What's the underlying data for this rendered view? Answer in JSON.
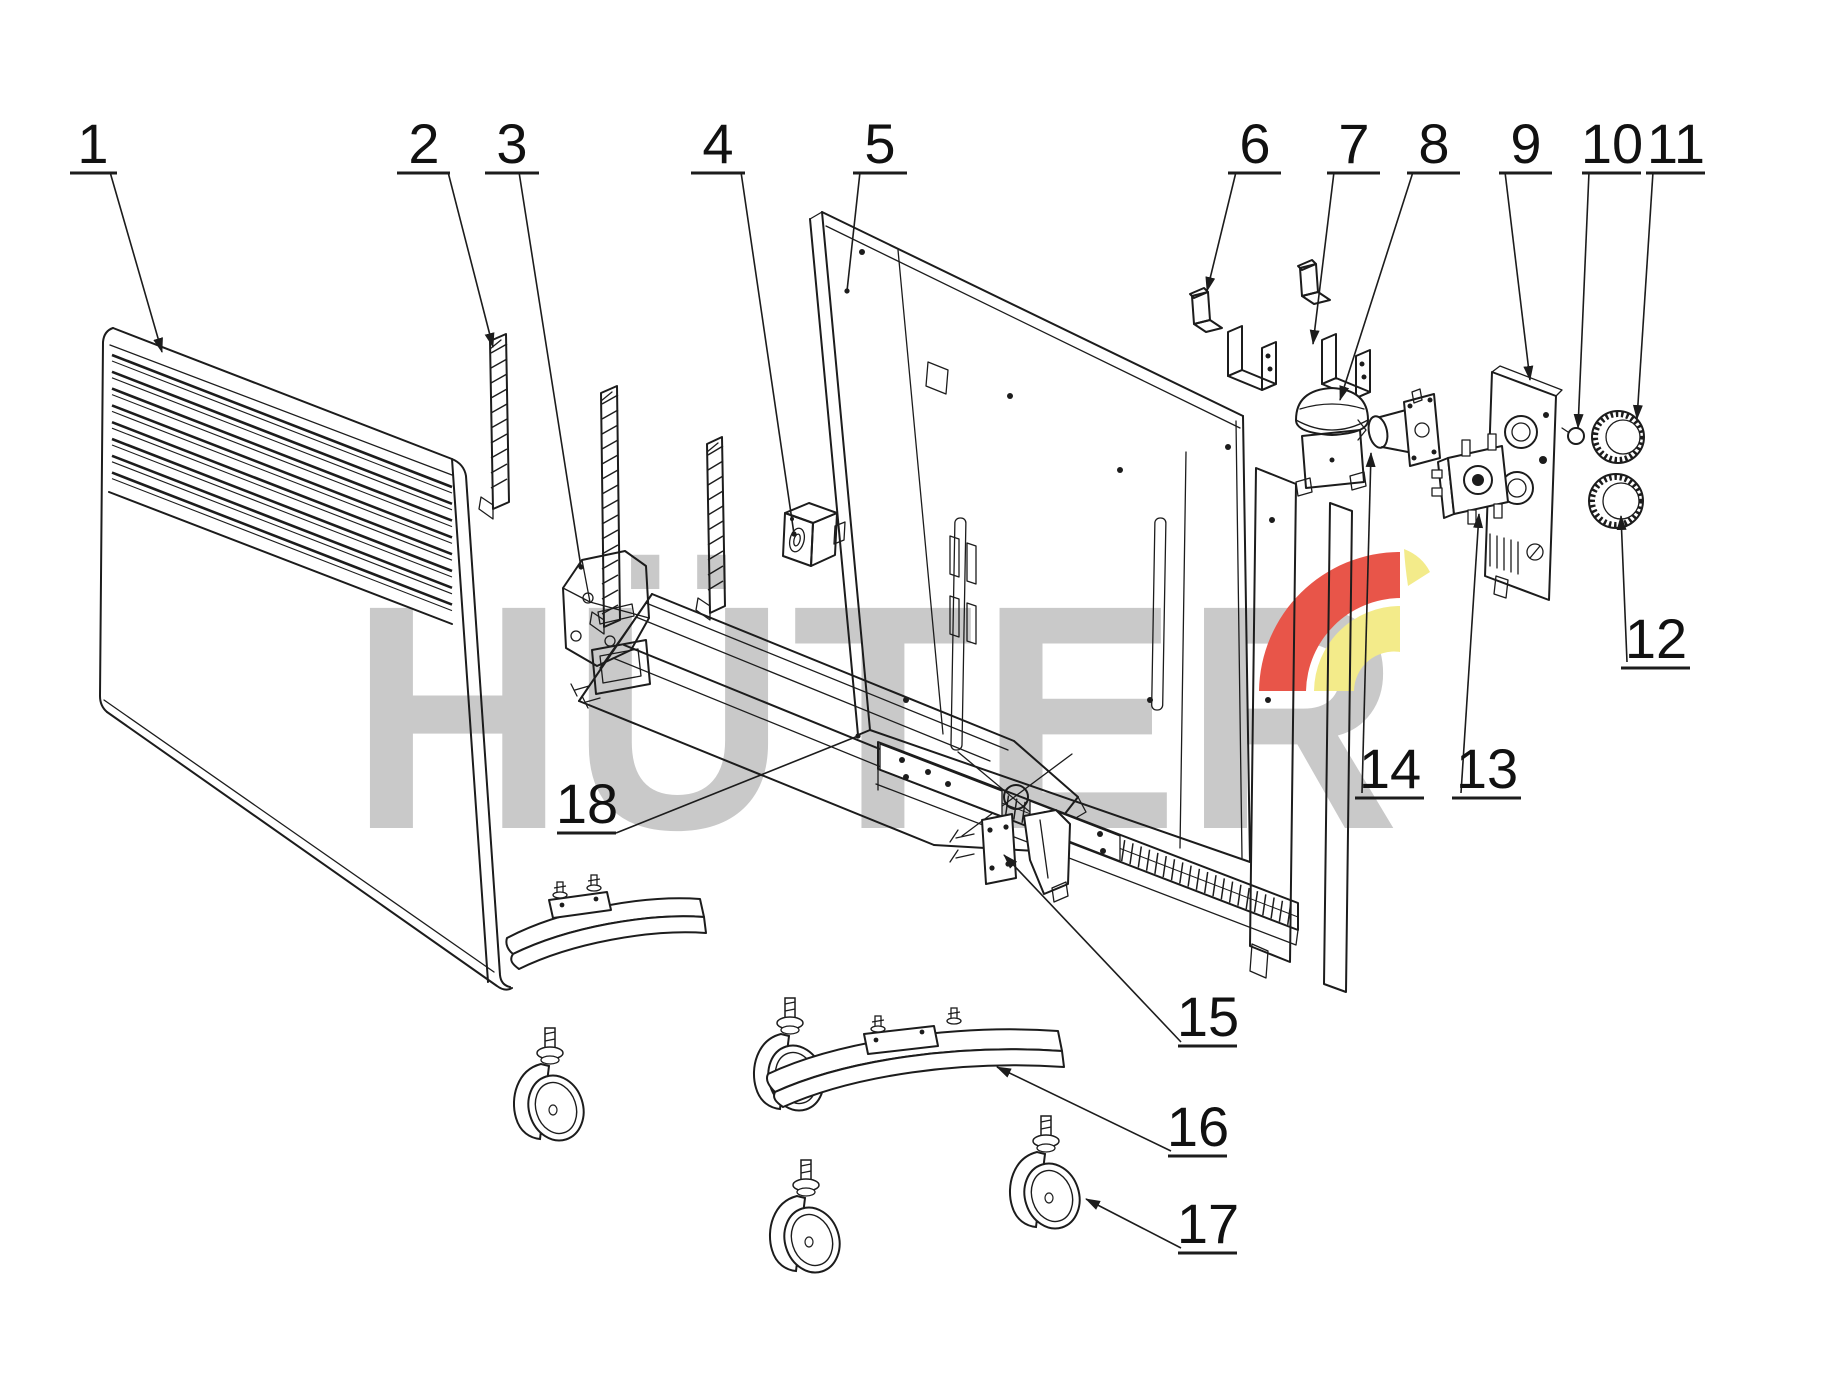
{
  "diagram": {
    "type": "exploded-parts-diagram",
    "subject": "convector heater parts drawing",
    "background": "#ffffff",
    "line_color": "#1c1c1c",
    "label_color": "#111111"
  },
  "watermark": {
    "text": "HÜTER",
    "color": "#c9c9c9",
    "logo_red": "#e85549",
    "logo_yellow": "#f3eb8a"
  },
  "callouts": [
    {
      "n": "1",
      "lx": 93,
      "ly": 163,
      "u": [
        70,
        117
      ],
      "from": [
        110,
        172
      ],
      "to": [
        162,
        352
      ],
      "end": "arrow"
    },
    {
      "n": "2",
      "lx": 424,
      "ly": 163,
      "u": [
        397,
        450
      ],
      "from": [
        448,
        172
      ],
      "to": [
        493,
        347
      ],
      "end": "arrow"
    },
    {
      "n": "3",
      "lx": 512,
      "ly": 163,
      "u": [
        485,
        539
      ],
      "from": [
        519,
        172
      ],
      "to": [
        581,
        567
      ],
      "end": "dot"
    },
    {
      "n": "4",
      "lx": 718,
      "ly": 163,
      "u": [
        691,
        745
      ],
      "from": [
        741,
        172
      ],
      "to": [
        794,
        534
      ],
      "end": "dot"
    },
    {
      "n": "5",
      "lx": 880,
      "ly": 163,
      "u": [
        853,
        907
      ],
      "from": [
        860,
        172
      ],
      "to": [
        847,
        291
      ],
      "end": "dot"
    },
    {
      "n": "6",
      "lx": 1255,
      "ly": 163,
      "u": [
        1228,
        1281
      ],
      "from": [
        1236,
        172
      ],
      "to": [
        1207,
        291
      ],
      "end": "arrow"
    },
    {
      "n": "7",
      "lx": 1354,
      "ly": 163,
      "u": [
        1327,
        1380
      ],
      "from": [
        1334,
        172
      ],
      "to": [
        1313,
        344
      ],
      "end": "arrow"
    },
    {
      "n": "8",
      "lx": 1434,
      "ly": 163,
      "u": [
        1407,
        1460
      ],
      "from": [
        1413,
        172
      ],
      "to": [
        1340,
        400
      ],
      "end": "arrow"
    },
    {
      "n": "9",
      "lx": 1526,
      "ly": 163,
      "u": [
        1499,
        1552
      ],
      "from": [
        1505,
        172
      ],
      "to": [
        1530,
        380
      ],
      "end": "arrow"
    },
    {
      "n": "10",
      "lx": 1612,
      "ly": 163,
      "u": [
        1582,
        1641
      ],
      "from": [
        1589,
        172
      ],
      "to": [
        1578,
        428
      ],
      "end": "arrow"
    },
    {
      "n": "11",
      "lx": 1676,
      "ly": 163,
      "u": [
        1646,
        1705
      ],
      "from": [
        1653,
        172
      ],
      "to": [
        1637,
        419
      ],
      "end": "arrow"
    },
    {
      "n": "12",
      "lx": 1656,
      "ly": 658,
      "u": [
        1621,
        1690
      ],
      "from": [
        1627,
        662
      ],
      "to": [
        1621,
        516
      ],
      "end": "arrow"
    },
    {
      "n": "13",
      "lx": 1487,
      "ly": 788,
      "u": [
        1452,
        1521
      ],
      "from": [
        1461,
        793
      ],
      "to": [
        1479,
        514
      ],
      "end": "arrow"
    },
    {
      "n": "14",
      "lx": 1390,
      "ly": 788,
      "u": [
        1355,
        1424
      ],
      "from": [
        1362,
        793
      ],
      "to": [
        1371,
        453
      ],
      "end": "arrow"
    },
    {
      "n": "15",
      "lx": 1208,
      "ly": 1036,
      "u": [
        1178,
        1237
      ],
      "from": [
        1181,
        1042
      ],
      "to": [
        1004,
        855
      ],
      "end": "arrow"
    },
    {
      "n": "16",
      "lx": 1198,
      "ly": 1146,
      "u": [
        1168,
        1227
      ],
      "from": [
        1171,
        1151
      ],
      "to": [
        997,
        1067
      ],
      "end": "arrow"
    },
    {
      "n": "17",
      "lx": 1208,
      "ly": 1243,
      "u": [
        1178,
        1237
      ],
      "from": [
        1181,
        1248
      ],
      "to": [
        1086,
        1199
      ],
      "end": "arrow"
    },
    {
      "n": "18",
      "lx": 587,
      "ly": 823,
      "u": [
        557,
        616
      ],
      "from": [
        616,
        833
      ],
      "to": [
        858,
        736
      ],
      "end": "dot"
    }
  ]
}
